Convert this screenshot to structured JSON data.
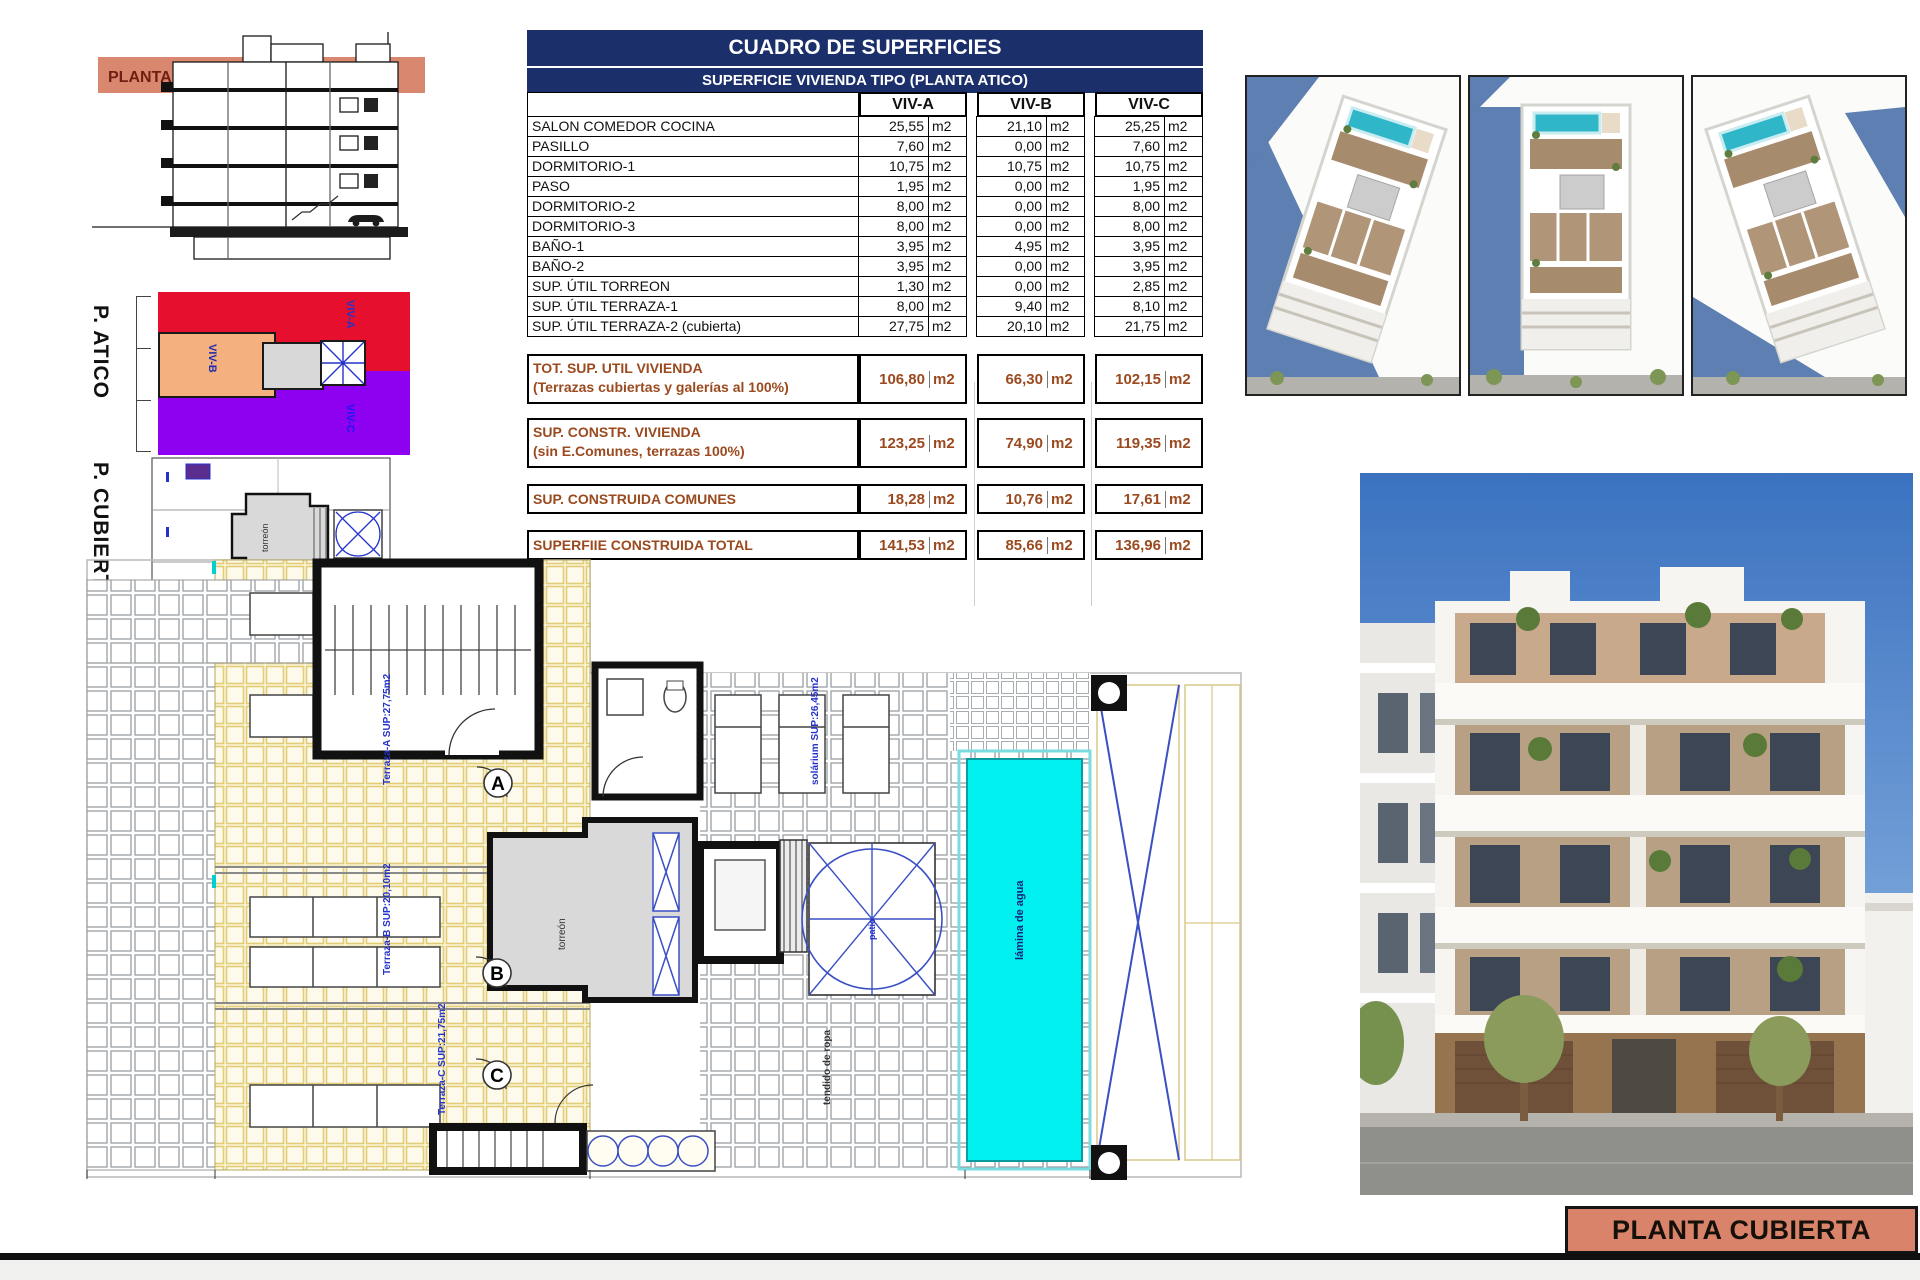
{
  "footer": {
    "sheet_label": "PLANTA CUBIERTA"
  },
  "section": {
    "band_label": "PLANTA CUBIERTA"
  },
  "atico": {
    "side_label": "P. ATICO",
    "viv_a": "VIV-A",
    "viv_b": "VIV-B",
    "viv_c": "VIV-C"
  },
  "cubiertas": {
    "side_label": "P. CUBIERTAS"
  },
  "table": {
    "title": "CUADRO DE SUPERFICIES",
    "subtitle": "SUPERFICIE VIVIENDA TIPO  (PLANTA ATICO)",
    "unit": "m2",
    "columns": [
      "VIV-A",
      "VIV-B",
      "VIV-C"
    ],
    "rows": [
      {
        "label": "SALON COMEDOR COCINA",
        "a": "25,55",
        "b": "21,10",
        "c": "25,25"
      },
      {
        "label": "PASILLO",
        "a": "7,60",
        "b": "0,00",
        "c": "7,60"
      },
      {
        "label": "DORMITORIO-1",
        "a": "10,75",
        "b": "10,75",
        "c": "10,75"
      },
      {
        "label": "PASO",
        "a": "1,95",
        "b": "0,00",
        "c": "1,95"
      },
      {
        "label": "DORMITORIO-2",
        "a": "8,00",
        "b": "0,00",
        "c": "8,00"
      },
      {
        "label": "DORMITORIO-3",
        "a": "8,00",
        "b": "0,00",
        "c": "8,00"
      },
      {
        "label": "BAÑO-1",
        "a": "3,95",
        "b": "4,95",
        "c": "3,95"
      },
      {
        "label": "BAÑO-2",
        "a": "3,95",
        "b": "0,00",
        "c": "3,95"
      },
      {
        "label": "SUP. ÚTIL TORREON",
        "a": "1,30",
        "b": "0,00",
        "c": "2,85"
      },
      {
        "label": "SUP. ÚTIL TERRAZA-1",
        "a": "8,00",
        "b": "9,40",
        "c": "8,10"
      },
      {
        "label": "SUP. ÚTIL TERRAZA-2 (cubierta)",
        "a": "27,75",
        "b": "20,10",
        "c": "21,75"
      }
    ],
    "totals": [
      {
        "label1": "TOT. SUP. UTIL VIVIENDA",
        "label2": "(Terrazas cubiertas y galerías al 100%)",
        "a": "106,80",
        "b": "66,30",
        "c": "102,15"
      },
      {
        "label1": "SUP. CONSTR. VIVIENDA",
        "label2": "(sin E.Comunes, terrazas 100%)",
        "a": "123,25",
        "b": "74,90",
        "c": "119,35"
      },
      {
        "label1": "SUP. CONSTRUIDA COMUNES",
        "label2": "",
        "a": "18,28",
        "b": "10,76",
        "c": "17,61"
      },
      {
        "label1": "SUPERFIIE CONSTRUIDA TOTAL",
        "label2": "",
        "a": "141,53",
        "b": "85,66",
        "c": "136,96"
      }
    ]
  },
  "roof_plan": {
    "letters": {
      "a": "A",
      "b": "B",
      "c": "C"
    },
    "labels": {
      "terraza_a": "Terraza-A SUP:27,75m2",
      "terraza_b": "Terraza-B SUP:20,10m2",
      "terraza_c": "Terraza-C SUP:21,75m2",
      "solarium": "solárium SUP:26,45m2",
      "pool": "lámina de agua",
      "laundry": "tendido de ropa",
      "patio": "patio",
      "torreon": "torreón"
    }
  },
  "colors": {
    "accent_salmon": "#D9836B",
    "table_header_navy": "#1B2F6B",
    "totals_brown": "#9B4A1F",
    "pool_cyan": "#00EFEF",
    "zone_red": "#E60F2E",
    "zone_orange": "#F4B07E",
    "zone_purple": "#8E00F0",
    "plan_blue": "#2433CC",
    "tile_yellow": "#E2CC74"
  }
}
